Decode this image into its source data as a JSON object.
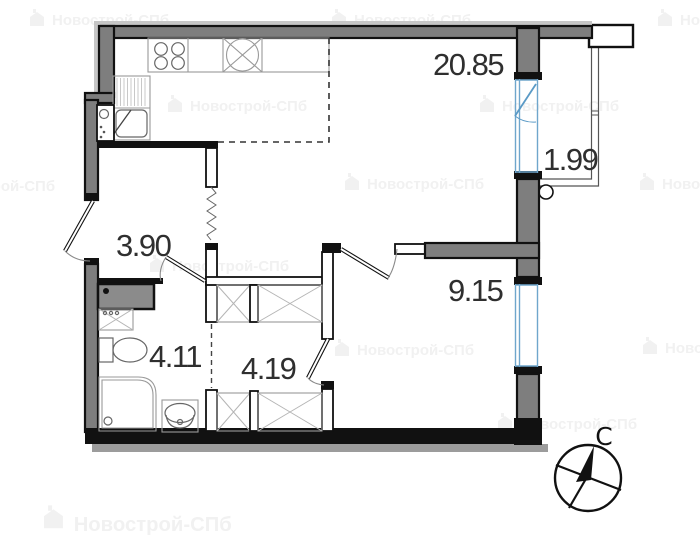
{
  "rooms": [
    {
      "id": "living-room",
      "area": "20.85"
    },
    {
      "id": "balcony",
      "area": "1.99"
    },
    {
      "id": "hallway",
      "area": "3.90"
    },
    {
      "id": "bathroom",
      "area": "4.11"
    },
    {
      "id": "wardrobe",
      "area": "4.19"
    },
    {
      "id": "bedroom",
      "area": "9.15"
    }
  ],
  "compass": {
    "north_label": "С"
  },
  "watermark": {
    "text": "Новострой-СПб"
  },
  "colors": {
    "wall_black": "#111111",
    "wall_gray_fill": "#7e7e7e",
    "outer_band_gray": "#9c9c9c",
    "window_blue": "#6fa6cc",
    "room_label_text": "#2f2f2f",
    "watermark_gray": "#f1f1f1"
  }
}
